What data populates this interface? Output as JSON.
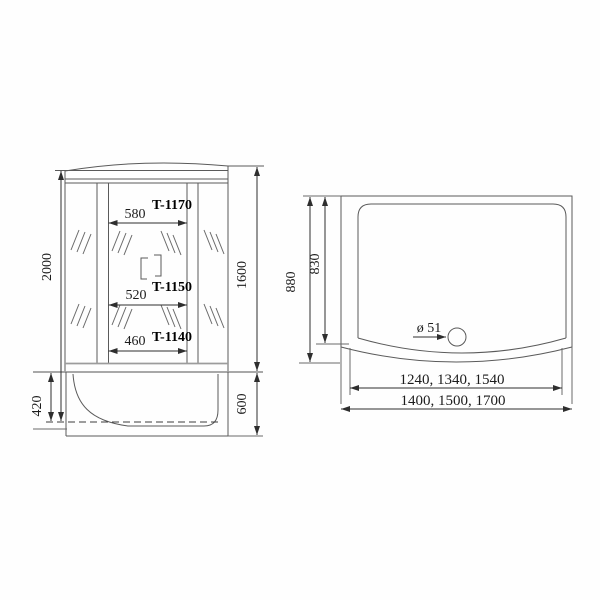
{
  "drawing": {
    "front_view": {
      "height_total": "2000",
      "glass_height": "1600",
      "tray_height": "420",
      "tray_depth": "600",
      "door_widths": [
        {
          "width": "580",
          "model": "T-1170"
        },
        {
          "width": "520",
          "model": "T-1150"
        },
        {
          "width": "460",
          "model": "T-1140"
        }
      ]
    },
    "top_view": {
      "depth_outer": "880",
      "depth_inner": "830",
      "drain_diameter": "ø 51",
      "width_inner": "1240, 1340, 1540",
      "width_outer": "1400, 1500, 1700"
    }
  }
}
